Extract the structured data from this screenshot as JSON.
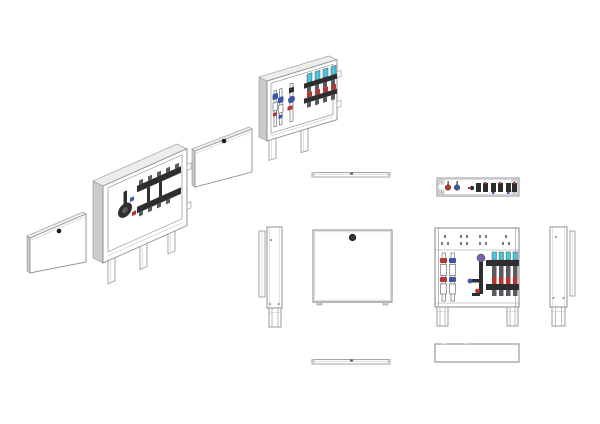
{
  "document": {
    "kind": "technical-drawing-sheet",
    "content": "manifold-cabinet-views",
    "visible_text": []
  },
  "colors": {
    "bg": "#ffffff",
    "line": "#8f9193",
    "line_soft": "#c2c4c6",
    "ink": "#3a3a3e",
    "panel": "#ffffff",
    "panel_shade": "#eceeec",
    "panel_edge": "#c9cccc",
    "metal_dark": "#2e2e31",
    "metal_mid": "#5a5a60",
    "slot": "#7a7a7e",
    "red": "#b5372f",
    "blue": "#3c57a8",
    "cyan": "#49c6dc",
    "purple": "#7a5fb0",
    "knob": "#1c1c1c"
  },
  "views": [
    {
      "name": "iso-cover-panel-left",
      "projection": "isometric",
      "shows": "cabinet front cover with lock"
    },
    {
      "name": "iso-cabinet-open-pump",
      "projection": "isometric",
      "shows": "open cabinet with pump group manifold"
    },
    {
      "name": "iso-cover-panel-middle",
      "projection": "isometric",
      "shows": "cabinet front cover with lock"
    },
    {
      "name": "iso-cabinet-open-manifold",
      "projection": "isometric",
      "shows": "open cabinet with flow-meter manifold"
    },
    {
      "name": "top-view-cover",
      "projection": "orthographic",
      "shows": "cover panel from above"
    },
    {
      "name": "top-view-cabinet",
      "projection": "orthographic",
      "shows": "open cabinet from above"
    },
    {
      "name": "side-view-left",
      "projection": "orthographic",
      "shows": "cabinet and cover from left side"
    },
    {
      "name": "front-view-cover",
      "projection": "orthographic",
      "shows": "closed cabinet front with lock knob"
    },
    {
      "name": "front-view-cabinet",
      "projection": "orthographic",
      "shows": "open cabinet front with manifold"
    },
    {
      "name": "side-view-right",
      "projection": "orthographic",
      "shows": "cabinet and cover from right side"
    },
    {
      "name": "bottom-view-cover",
      "projection": "orthographic",
      "shows": "cover panel from below"
    },
    {
      "name": "bottom-view-cabinet",
      "projection": "orthographic",
      "shows": "cabinet from below"
    }
  ]
}
